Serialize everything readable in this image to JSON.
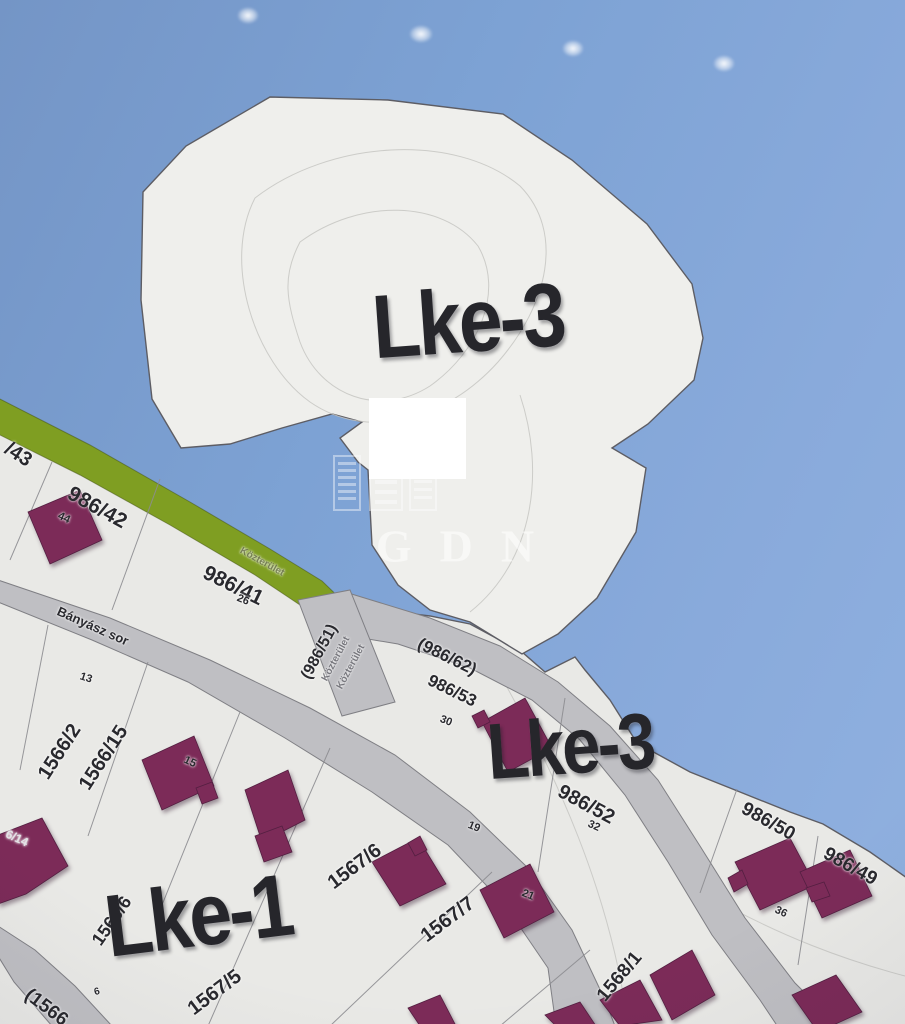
{
  "app": {
    "description": "Zoning / cadastral map viewer (photo of screen)"
  },
  "colors": {
    "sky": "#7da2d4",
    "land": "#e9e9e6",
    "zone-area": "#efefec",
    "road": "#bfbfc3",
    "road-border": "#7f7f84",
    "green-road": "#7f9e22",
    "building": "#7c2b58",
    "building-border": "#531f41",
    "label": "#29292e"
  },
  "watermark": {
    "text": "GDN",
    "icon": "buildings-logo-icon"
  },
  "map": {
    "zone_labels": [
      {
        "id": "zone-label-lke3-upper",
        "text": "Lke-3",
        "x": 468,
        "y": 322,
        "rot": -4,
        "size": 82
      },
      {
        "id": "zone-label-lke3-lower",
        "text": "Lke-3",
        "x": 570,
        "y": 747,
        "rot": -4,
        "size": 72
      },
      {
        "id": "zone-label-lke1",
        "text": "Lke-1",
        "x": 198,
        "y": 916,
        "rot": -7,
        "size": 80
      }
    ],
    "parcel_labels": [
      {
        "id": "parcel-43",
        "text": "/43",
        "x": 18,
        "y": 455,
        "rot": 33,
        "size": 20
      },
      {
        "id": "parcel-986-42",
        "text": "986/42",
        "x": 97,
        "y": 508,
        "rot": 29,
        "size": 21
      },
      {
        "id": "parcel-986-41",
        "text": "986/41",
        "x": 233,
        "y": 586,
        "rot": 26,
        "size": 21
      },
      {
        "id": "parcel-986-51",
        "text": "(986/51)",
        "x": 320,
        "y": 652,
        "rot": -62,
        "size": 16
      },
      {
        "id": "parcel-986-62",
        "text": "(986/62)",
        "x": 447,
        "y": 657,
        "rot": 26,
        "size": 17
      },
      {
        "id": "parcel-986-53",
        "text": "986/53",
        "x": 452,
        "y": 691,
        "rot": 26,
        "size": 17
      },
      {
        "id": "parcel-986-52",
        "text": "986/52",
        "x": 586,
        "y": 805,
        "rot": 28,
        "size": 20
      },
      {
        "id": "parcel-986-50",
        "text": "986/50",
        "x": 768,
        "y": 822,
        "rot": 29,
        "size": 19
      },
      {
        "id": "parcel-986-49",
        "text": "986/49",
        "x": 850,
        "y": 867,
        "rot": 29,
        "size": 19
      },
      {
        "id": "parcel-1566-2",
        "text": "1566/2",
        "x": 60,
        "y": 752,
        "rot": -57,
        "size": 20
      },
      {
        "id": "parcel-1566-15",
        "text": "1566/15",
        "x": 104,
        "y": 758,
        "rot": -57,
        "size": 20
      },
      {
        "id": "parcel-1566-6",
        "text": "1566/6",
        "x": 112,
        "y": 921,
        "rot": -55,
        "size": 18
      },
      {
        "id": "parcel-1567-6",
        "text": "1567/6",
        "x": 355,
        "y": 867,
        "rot": -37,
        "size": 20
      },
      {
        "id": "parcel-1567-7",
        "text": "1567/7",
        "x": 448,
        "y": 920,
        "rot": -37,
        "size": 20
      },
      {
        "id": "parcel-1567-5",
        "text": "1567/5",
        "x": 215,
        "y": 993,
        "rot": -37,
        "size": 20
      },
      {
        "id": "parcel-1568-1",
        "text": "1568/1",
        "x": 620,
        "y": 977,
        "rot": -50,
        "size": 19
      },
      {
        "id": "road-label-1566",
        "text": "(1566",
        "x": 46,
        "y": 1008,
        "rot": 37,
        "size": 19
      }
    ],
    "street_labels": [
      {
        "id": "street-banyasz-sor",
        "text": "Bányász sor",
        "x": 93,
        "y": 626,
        "rot": 24,
        "size": 13
      },
      {
        "id": "street-kozterulet-green",
        "text": "Közterület",
        "x": 262,
        "y": 562,
        "rot": 29,
        "size": 10,
        "color": "rgba(88,96,52,0.75)"
      },
      {
        "id": "street-kozterulet-1",
        "text": "Közterület",
        "x": 336,
        "y": 659,
        "rot": -62,
        "size": 10,
        "color": "rgba(108,108,114,0.9)"
      },
      {
        "id": "street-kozterulet-2",
        "text": "Közterület",
        "x": 351,
        "y": 667,
        "rot": -62,
        "size": 10,
        "color": "rgba(108,108,114,0.9)"
      }
    ],
    "house_numbers": [
      {
        "id": "housenum-44",
        "text": "44",
        "x": 64,
        "y": 518,
        "rot": 25,
        "size": 11
      },
      {
        "id": "housenum-26",
        "text": "26",
        "x": 243,
        "y": 600,
        "rot": 22,
        "size": 11
      },
      {
        "id": "housenum-13",
        "text": "13",
        "x": 86,
        "y": 678,
        "rot": 18,
        "size": 11
      },
      {
        "id": "housenum-15",
        "text": "15",
        "x": 190,
        "y": 762,
        "rot": 25,
        "size": 11
      },
      {
        "id": "housenum-30",
        "text": "30",
        "x": 446,
        "y": 721,
        "rot": 22,
        "size": 11
      },
      {
        "id": "housenum-32",
        "text": "32",
        "x": 594,
        "y": 826,
        "rot": 24,
        "size": 11
      },
      {
        "id": "housenum-19",
        "text": "19",
        "x": 474,
        "y": 827,
        "rot": 22,
        "size": 11
      },
      {
        "id": "housenum-36",
        "text": "36",
        "x": 781,
        "y": 912,
        "rot": 25,
        "size": 11
      },
      {
        "id": "housenum-21",
        "text": "21",
        "x": 528,
        "y": 895,
        "rot": 22,
        "size": 11
      },
      {
        "id": "housenum-6",
        "text": "6",
        "x": 97,
        "y": 992,
        "rot": -15,
        "size": 10
      },
      {
        "id": "housenum-6-14",
        "text": "6/14",
        "x": 17,
        "y": 838,
        "rot": 25,
        "size": 12,
        "color": "#e3e3e6"
      }
    ]
  }
}
